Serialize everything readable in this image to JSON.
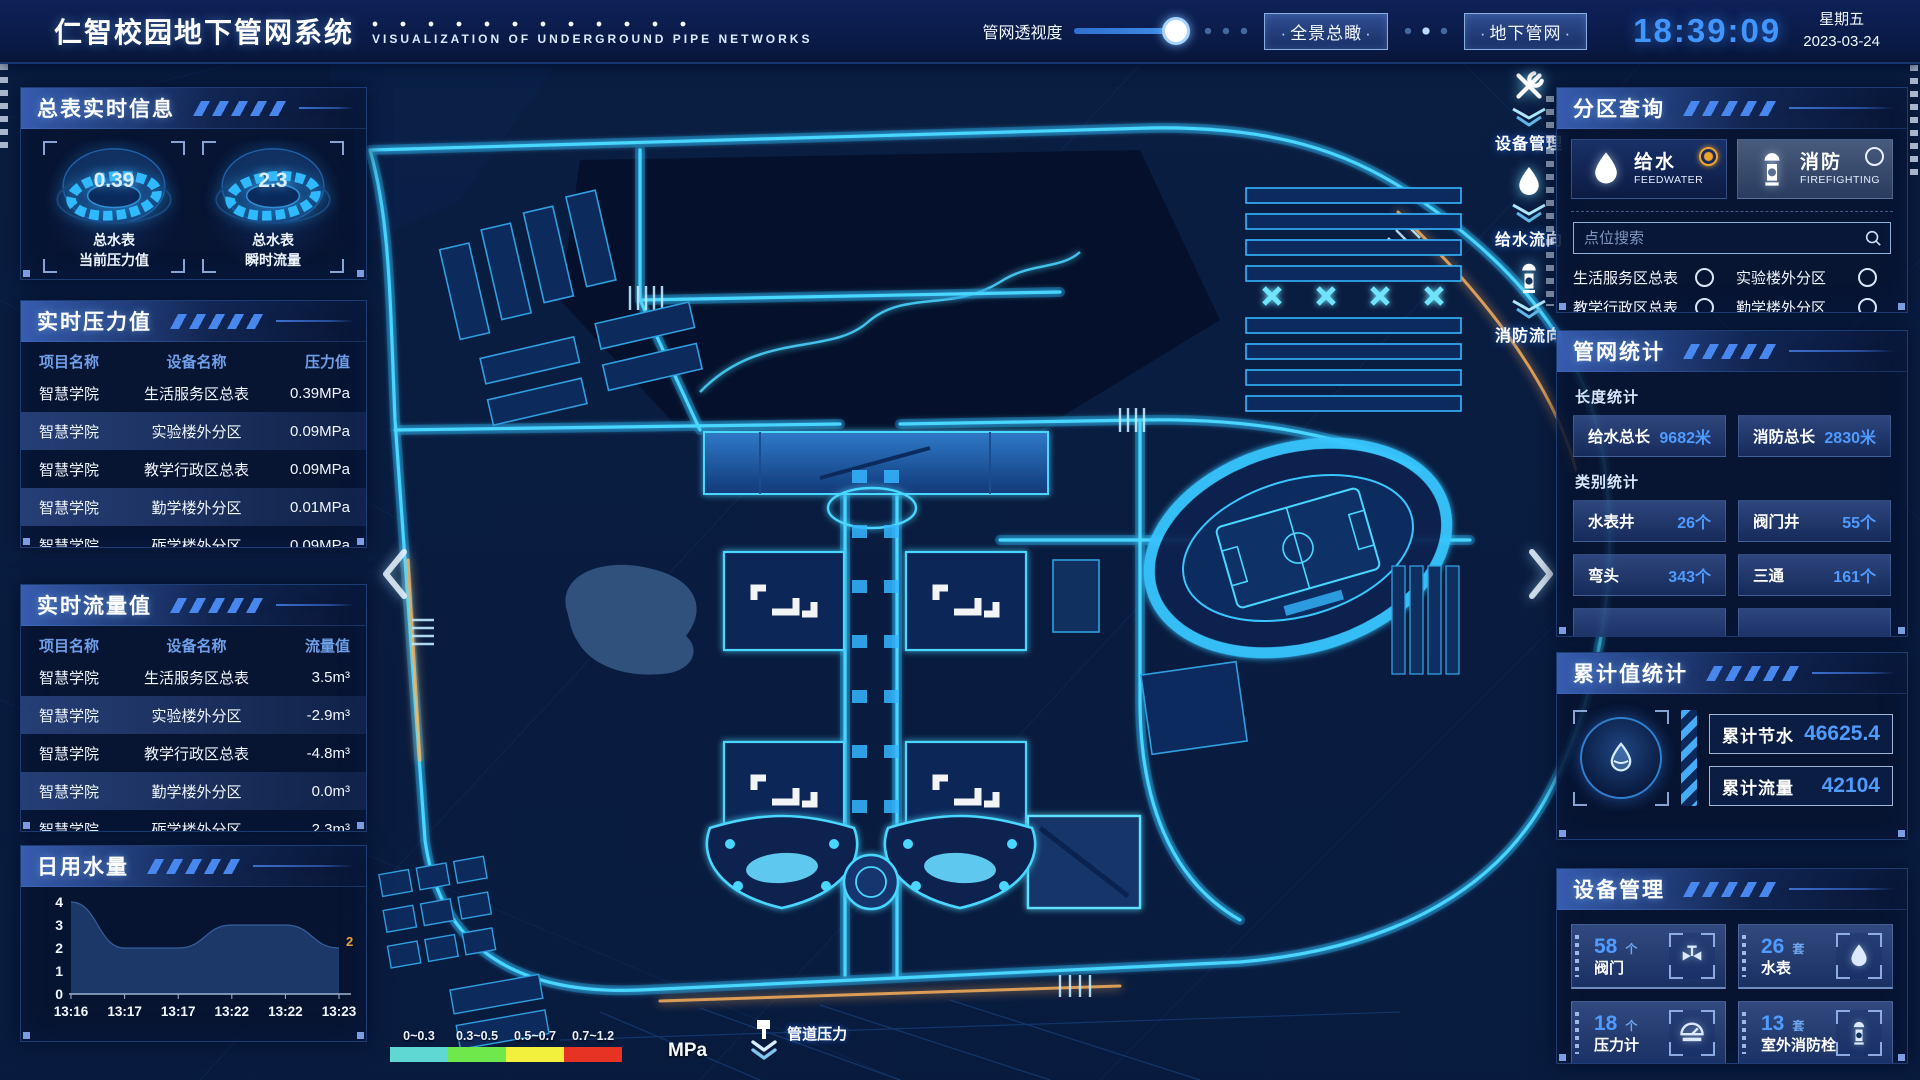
{
  "colors": {
    "accent": "#35c9ff",
    "value_blue": "#4f9bff",
    "alert_orange": "#e8a23c"
  },
  "header": {
    "title": "仁智校园地下管网系统",
    "subtitle": "VISUALIZATION OF UNDERGROUND PIPE NETWORKS",
    "opacity_label": "管网透视度",
    "buttons": [
      {
        "label": "全景总瞰"
      },
      {
        "label": "地下管网"
      }
    ],
    "time": "18:39:09",
    "weekday": "星期五",
    "date": "2023-03-24"
  },
  "left": {
    "realtime_info": {
      "title": "总表实时信息",
      "gauges": [
        {
          "value": "0.39",
          "label_line1": "总水表",
          "label_line2": "当前压力值"
        },
        {
          "value": "2.3",
          "label_line1": "总水表",
          "label_line2": "瞬时流量"
        }
      ]
    },
    "pressure": {
      "title": "实时压力值",
      "headers": [
        "项目名称",
        "设备名称",
        "压力值"
      ],
      "rows": [
        [
          "智慧学院",
          "生活服务区总表",
          "0.39MPa"
        ],
        [
          "智慧学院",
          "实验楼外分区",
          "0.09MPa"
        ],
        [
          "智慧学院",
          "教学行政区总表",
          "0.09MPa"
        ],
        [
          "智慧学院",
          "勤学楼外分区",
          "0.01MPa"
        ],
        [
          "智慧学院",
          "砺学楼外分区",
          "0.09MPa"
        ]
      ]
    },
    "flow": {
      "title": "实时流量值",
      "headers": [
        "项目名称",
        "设备名称",
        "流量值"
      ],
      "rows": [
        [
          "智慧学院",
          "生活服务区总表",
          "3.5m³"
        ],
        [
          "智慧学院",
          "实验楼外分区",
          "-2.9m³"
        ],
        [
          "智慧学院",
          "教学行政区总表",
          "-4.8m³"
        ],
        [
          "智慧学院",
          "勤学楼外分区",
          "0.0m³"
        ],
        [
          "智慧学院",
          "砺学楼外分区",
          "2.3m³"
        ]
      ]
    },
    "daily_water": {
      "title": "日用水量"
    }
  },
  "chart_data": {
    "type": "area",
    "title": "日用水量",
    "x": [
      "13:16",
      "13:17",
      "13:17",
      "13:22",
      "13:22",
      "13:23"
    ],
    "values": [
      4,
      2,
      2,
      3,
      3,
      2
    ],
    "ylim": [
      0,
      4
    ],
    "yticks": [
      0,
      1,
      2,
      3,
      4
    ],
    "last_point_label": "2",
    "grid": false,
    "area_color": "#1d3a6b"
  },
  "map": {
    "side_tools": [
      {
        "label": "设备管理",
        "icon": "tools-icon"
      },
      {
        "label": "给水流向",
        "icon": "water-drop-icon"
      },
      {
        "label": "消防流向",
        "icon": "hydrant-icon"
      }
    ],
    "legend": {
      "ranges": [
        {
          "label": "0~0.3",
          "color": "#5fd8d3"
        },
        {
          "label": "0.3~0.5",
          "color": "#6ee84a"
        },
        {
          "label": "0.5~0.7",
          "color": "#f2ef3d"
        },
        {
          "label": "0.7~1.2",
          "color": "#e63323"
        }
      ],
      "unit": "MPa",
      "pressure_label": "管道压力"
    }
  },
  "right": {
    "zone_query": {
      "title": "分区查询",
      "tabs": [
        {
          "label": "给水",
          "sub": "FEEDWATER",
          "selected": true
        },
        {
          "label": "消防",
          "sub": "FIREFIGHTING",
          "selected": false
        }
      ],
      "search_placeholder": "点位搜索",
      "items": [
        "生活服务区总表",
        "实验楼外分区",
        "教学行政区总表",
        "勤学楼外分区",
        "砺学楼外分区",
        "宿舍区泵房"
      ]
    },
    "pipe_stats": {
      "title": "管网统计",
      "length_title": "长度统计",
      "length_stats": [
        {
          "label": "给水总长",
          "value": "9682米"
        },
        {
          "label": "消防总长",
          "value": "2830米"
        }
      ],
      "category_title": "类别统计",
      "category_stats": [
        {
          "label": "水表井",
          "value": "26个"
        },
        {
          "label": "阀门井",
          "value": "55个"
        },
        {
          "label": "弯头",
          "value": "343个"
        },
        {
          "label": "三通",
          "value": "161个"
        }
      ]
    },
    "cumulative": {
      "title": "累计值统计",
      "stats": [
        {
          "label": "累计节水",
          "value": "46625.4"
        },
        {
          "label": "累计流量",
          "value": "42104"
        }
      ]
    },
    "devices": {
      "title": "设备管理",
      "cards": [
        {
          "count": "58",
          "unit": "个",
          "label": "阀门",
          "icon": "valve-icon"
        },
        {
          "count": "26",
          "unit": "套",
          "label": "水表",
          "icon": "water-meter-icon"
        },
        {
          "count": "18",
          "unit": "个",
          "label": "压力计",
          "icon": "pressure-gauge-icon"
        },
        {
          "count": "13",
          "unit": "套",
          "label": "室外消防栓",
          "icon": "hydrant-icon"
        }
      ]
    }
  }
}
